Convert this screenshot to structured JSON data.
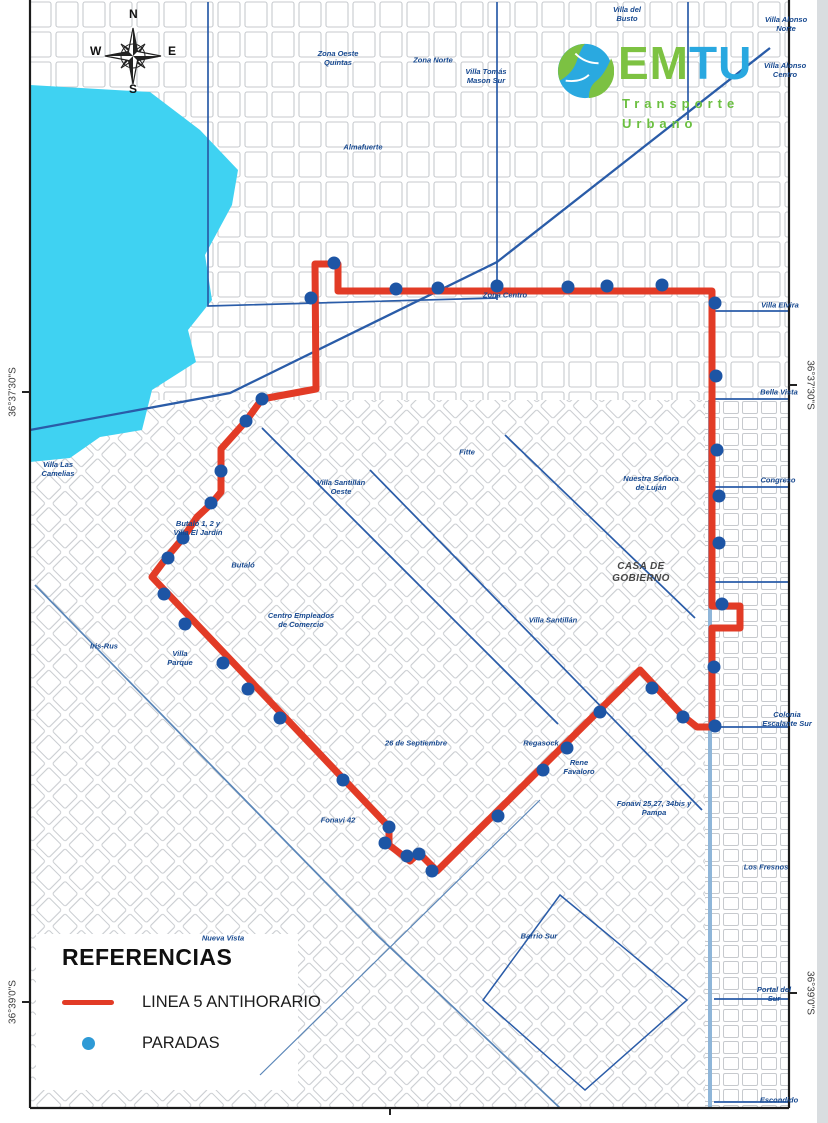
{
  "logo": {
    "em": "EM",
    "tu": "TU",
    "line1": "Transporte",
    "line2": "Urbano"
  },
  "compass": {
    "n": "N",
    "e": "E",
    "s": "S",
    "w": "W"
  },
  "legend": {
    "title": "REFERENCIAS",
    "items": [
      {
        "type": "line",
        "label": "LINEA 5 ANTIHORARIO",
        "color": "#e23b26"
      },
      {
        "type": "dot",
        "label": "PARADAS",
        "color": "#2e9ad6"
      }
    ]
  },
  "colors": {
    "route_red": "#e23b26",
    "stop_blue": "#1d55a5",
    "lake_cyan": "#3fd2f2",
    "boundary_blue": "#2a5ca8",
    "label_navy": "#16488f"
  },
  "map": {
    "edge_labels": [
      {
        "text": "36°37'30\"S",
        "x": 13,
        "y": 392,
        "side": "left"
      },
      {
        "text": "36°39'0\"S",
        "x": 13,
        "y": 1002,
        "side": "left"
      },
      {
        "text": "36°37'30\"S",
        "x": 810,
        "y": 385,
        "side": "right"
      },
      {
        "text": "36°39'0\"S",
        "x": 810,
        "y": 993,
        "side": "right"
      }
    ],
    "region_labels": [
      {
        "text": "Villa del Busto",
        "x": 627,
        "y": 14,
        "w": 48
      },
      {
        "text": "Villa Alonso Norte",
        "x": 786,
        "y": 24,
        "w": 44
      },
      {
        "text": "Villa Alonso Centro",
        "x": 785,
        "y": 70,
        "w": 44
      },
      {
        "text": "Zona Oeste Quintas",
        "x": 338,
        "y": 58,
        "w": 58
      },
      {
        "text": "Zona Norte",
        "x": 433,
        "y": 60,
        "w": 70
      },
      {
        "text": "Villa Tomás Mason Sur",
        "x": 486,
        "y": 76,
        "w": 58
      },
      {
        "text": "Almafuerte",
        "x": 363,
        "y": 147,
        "w": 80
      },
      {
        "text": "Zona Centro",
        "x": 505,
        "y": 295,
        "w": 46
      },
      {
        "text": "Villa Elvira",
        "x": 780,
        "y": 305,
        "w": 66
      },
      {
        "text": "Bella Vista",
        "x": 779,
        "y": 392,
        "w": 66
      },
      {
        "text": "Villa Las Camelias",
        "x": 58,
        "y": 469,
        "w": 52
      },
      {
        "text": "Fitte",
        "x": 467,
        "y": 452,
        "w": 40
      },
      {
        "text": "Villa Santillán Oeste",
        "x": 341,
        "y": 487,
        "w": 56
      },
      {
        "text": "Nuestra Señora de Luján",
        "x": 651,
        "y": 483,
        "w": 58
      },
      {
        "text": "Congreso",
        "x": 778,
        "y": 480,
        "w": 64
      },
      {
        "text": "Butaló 1, 2 y Villa El Jardín",
        "x": 198,
        "y": 528,
        "w": 56
      },
      {
        "text": "Butaló",
        "x": 243,
        "y": 565,
        "w": 50
      },
      {
        "text": "CASA DE GOBIERNO",
        "x": 641,
        "y": 573,
        "w": 92,
        "style": "gov"
      },
      {
        "text": "Centro Empleados de Comercio",
        "x": 301,
        "y": 620,
        "w": 68
      },
      {
        "text": "Villa Santillán",
        "x": 553,
        "y": 620,
        "w": 52
      },
      {
        "text": "Iris-Rus",
        "x": 104,
        "y": 646,
        "w": 50
      },
      {
        "text": "Villa Parque",
        "x": 180,
        "y": 658,
        "w": 42
      },
      {
        "text": "26 de Septiembre",
        "x": 416,
        "y": 743,
        "w": 66
      },
      {
        "text": "Regasock",
        "x": 541,
        "y": 743,
        "w": 60
      },
      {
        "text": "Rene Favaloro",
        "x": 579,
        "y": 767,
        "w": 48
      },
      {
        "text": "Colonia Escalante Sur",
        "x": 787,
        "y": 719,
        "w": 56
      },
      {
        "text": "Fonavi 25,27, 34bis y Pampa",
        "x": 654,
        "y": 808,
        "w": 76
      },
      {
        "text": "Fonavi 42",
        "x": 338,
        "y": 820,
        "w": 40
      },
      {
        "text": "Los Fresnos",
        "x": 766,
        "y": 867,
        "w": 70
      },
      {
        "text": "Nueva Vista",
        "x": 223,
        "y": 938,
        "w": 44
      },
      {
        "text": "Barrio Sur",
        "x": 539,
        "y": 936,
        "w": 44
      },
      {
        "text": "Portal del Sur",
        "x": 774,
        "y": 994,
        "w": 48
      },
      {
        "text": "Escondido",
        "x": 779,
        "y": 1100,
        "w": 70
      }
    ],
    "route": {
      "name": "LINEA 5 ANTIHORARIO",
      "points": [
        [
          315,
          264
        ],
        [
          338,
          264
        ],
        [
          338,
          291
        ],
        [
          712,
          291
        ],
        [
          712,
          606
        ],
        [
          740,
          606
        ],
        [
          740,
          628
        ],
        [
          712,
          628
        ],
        [
          712,
          727
        ],
        [
          697,
          727
        ],
        [
          683,
          716
        ],
        [
          640,
          670
        ],
        [
          437,
          871
        ],
        [
          419,
          853
        ],
        [
          410,
          861
        ],
        [
          389,
          845
        ],
        [
          389,
          827
        ],
        [
          152,
          577
        ],
        [
          167,
          557
        ],
        [
          183,
          538
        ],
        [
          197,
          517
        ],
        [
          211,
          504
        ],
        [
          221,
          492
        ],
        [
          221,
          449
        ],
        [
          246,
          421
        ],
        [
          262,
          399
        ],
        [
          316,
          389
        ],
        [
          315,
          264
        ]
      ],
      "stops": [
        [
          311,
          298
        ],
        [
          334,
          263
        ],
        [
          396,
          289
        ],
        [
          438,
          288
        ],
        [
          497,
          286
        ],
        [
          568,
          287
        ],
        [
          607,
          286
        ],
        [
          662,
          285
        ],
        [
          715,
          303
        ],
        [
          716,
          376
        ],
        [
          717,
          450
        ],
        [
          719,
          496
        ],
        [
          719,
          543
        ],
        [
          722,
          604
        ],
        [
          714,
          667
        ],
        [
          715,
          726
        ],
        [
          683,
          717
        ],
        [
          652,
          688
        ],
        [
          600,
          712
        ],
        [
          567,
          748
        ],
        [
          543,
          770
        ],
        [
          498,
          816
        ],
        [
          432,
          871
        ],
        [
          419,
          854
        ],
        [
          407,
          856
        ],
        [
          385,
          843
        ],
        [
          389,
          827
        ],
        [
          343,
          780
        ],
        [
          280,
          718
        ],
        [
          248,
          689
        ],
        [
          223,
          663
        ],
        [
          185,
          624
        ],
        [
          164,
          594
        ],
        [
          168,
          558
        ],
        [
          183,
          538
        ],
        [
          211,
          503
        ],
        [
          221,
          471
        ],
        [
          246,
          421
        ],
        [
          262,
          399
        ]
      ]
    }
  }
}
